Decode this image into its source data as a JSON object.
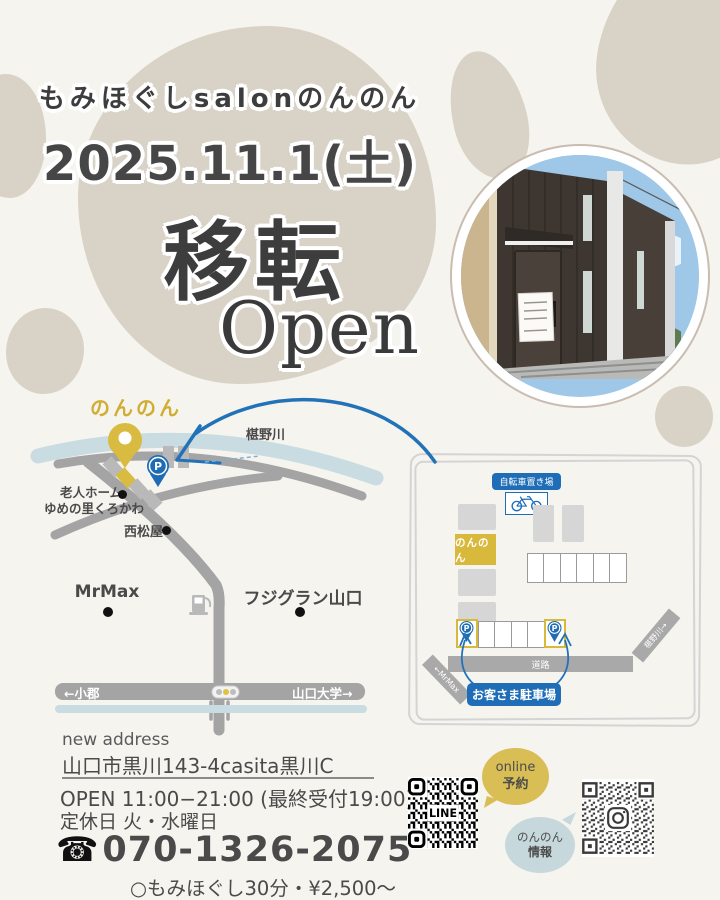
{
  "header": {
    "salon_name": "もみほぐしsalonのんのん",
    "date": "2025.11.1(土)",
    "headline_move": "移転",
    "headline_open": "Open"
  },
  "map": {
    "shop_label": "のんのん",
    "river_label": "椹野川",
    "nursing_home_line1": "老人ホーム",
    "nursing_home_line2": "ゆめの里くろかわ",
    "nishimatsuya": "西松屋",
    "mrmax": "MrMax",
    "fujigran": "フジグラン山口",
    "dir_left": "←小郡",
    "dir_right": "山口大学→",
    "p": "P"
  },
  "parking": {
    "bicycle_label": "自転車置き場",
    "shop_label": "のんのん",
    "road_label": "道路",
    "road_left_label": "←MrMax",
    "road_right_label": "椹野川→",
    "customer_label": "お客さま駐車場",
    "p": "P"
  },
  "info": {
    "new_address_label": "new address",
    "address": "山口市黒川143-4casita黒川C",
    "hours": "OPEN 11:00−21:00 (最終受付19:00)",
    "closed": "定休日 火・水曜日",
    "phone_icon": "☎",
    "phone": "070-1326-2075",
    "price": "○もみほぐし30分・¥2,500〜"
  },
  "qr": {
    "line_text": "LINE",
    "online_line1": "online",
    "online_line2": "予約",
    "info_line1": "のんのん",
    "info_line2": "情報"
  },
  "colors": {
    "accent_blue": "#1e6db6",
    "accent_gold": "#d9bb42",
    "blob_tan": "#d9d2c6",
    "river_blue": "#c9dce1",
    "road_gray": "#a4a4a4"
  }
}
